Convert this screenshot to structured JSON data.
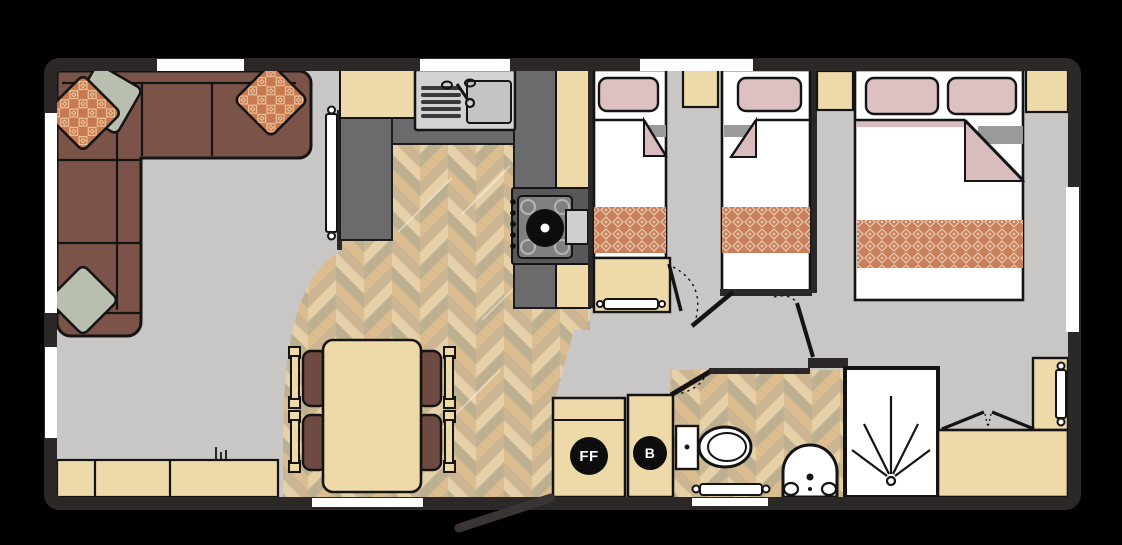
{
  "floorplan": {
    "labels": {
      "fridge_freezer": "FF",
      "boiler": "B"
    },
    "palette": {
      "wall": "#2d2828",
      "floor": "#c9c7c5",
      "wood_a": "#dcbd90",
      "wood_b": "#cbb592",
      "wood_c": "#e6d0a8",
      "wood_d": "#bdb091",
      "worktop": "#6b6b6d",
      "appliance_dark": "#58585a",
      "hob_panel": "#808083",
      "cabinet": "#eed9a9",
      "sofa": "#7b5349",
      "chair": "#6f4a42",
      "pillow": "#dcc0c2",
      "fold_pink": "#d9bcbe",
      "fold_gray": "#9b9b9b",
      "runner": "#c9805a",
      "runner_motif": "#ecd3bb",
      "sage": "#b9bfae",
      "cushion": "#c9794f",
      "cushion_motif": "#ecc9a0",
      "sink": "#d2d2d2",
      "fixture_white": "#ffffff",
      "line": "#141414"
    }
  }
}
